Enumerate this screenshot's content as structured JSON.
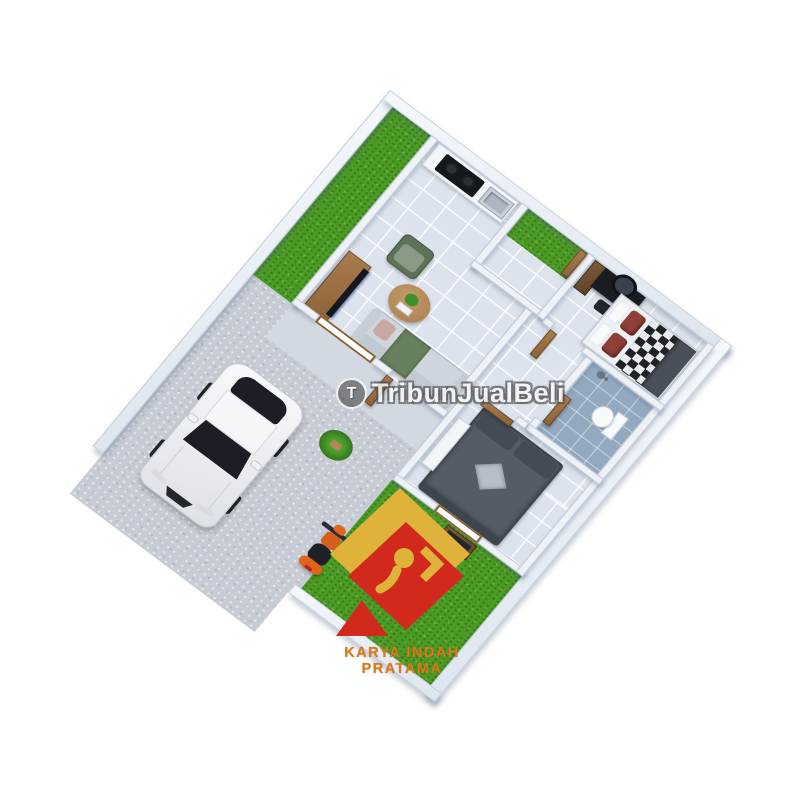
{
  "watermark": {
    "badge_letter": "T",
    "text": "TribunJualBeli"
  },
  "logo": {
    "company_name": "KARYA INDAH PRATAMA",
    "colors": {
      "gold": "#dfb33a",
      "red": "#d2291d",
      "text_orange": "#d97a1c"
    }
  },
  "scene": {
    "description": "3D isometric render of a small one-storey house floor plan with carport, side garden and backyard",
    "palette": {
      "background": "#ffffff",
      "grass": "#4c9b26",
      "floor_tile": "#dce3ec",
      "bathroom_floor": "#93a9bf",
      "driveway_concrete": "#c7ccd4",
      "terrace": "#d3d9e0",
      "interior_wall": "#eef2f7",
      "boundary_wall": "#e7ecf2",
      "wood_door": "#9c6f42",
      "car_body": "#f2f4f6",
      "car_glass": "#1b1e24",
      "scooter_orange": "#e2641c",
      "sofa_gray": "#ced5dc",
      "armchair_green": "#5d7257",
      "bed2_gray": "#565c66",
      "maroon_pillow": "#8e4038"
    },
    "objects": [
      "white-sedan-car",
      "orange-scooter",
      "potted-plant",
      "kitchen-counter",
      "cooktop",
      "kitchen-sink",
      "tv-console",
      "tv",
      "green-armchair",
      "round-coffee-table",
      "gray-sofa",
      "bed-white-checkered",
      "vanity-desk-with-round-mirror",
      "wooden-ladder-shelf",
      "toilet",
      "shower-head",
      "bed-gray",
      "white-dresser",
      "backyard-shelf",
      "wooden-open-doors",
      "side-yard-grass",
      "backyard-grass"
    ]
  }
}
